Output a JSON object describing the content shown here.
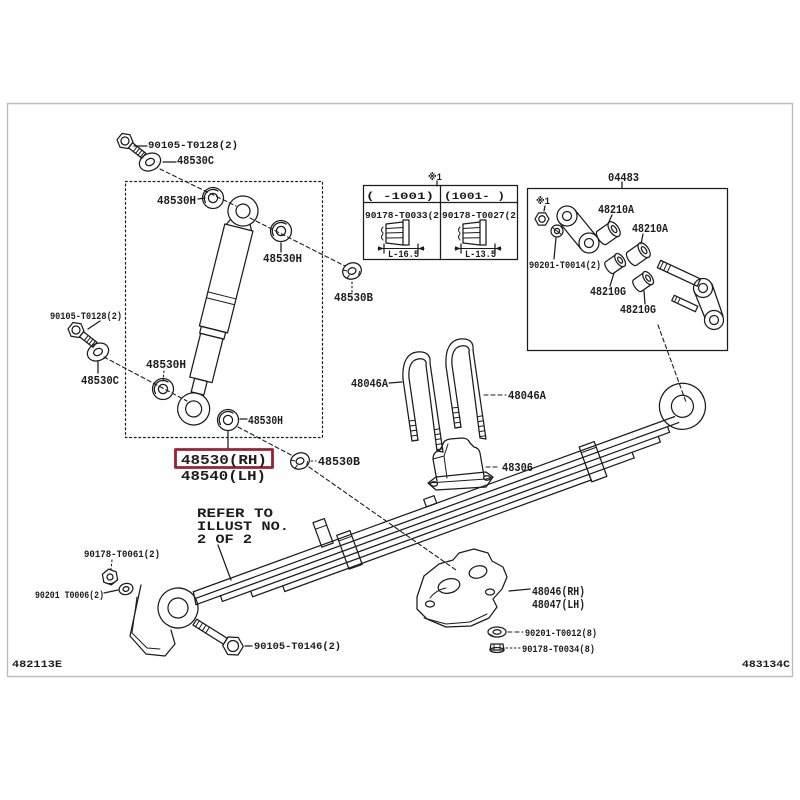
{
  "colors": {
    "line": "#1c1c1c",
    "frame": "#bdbdbd",
    "highlight": "#9e1f33",
    "background": "#ffffff"
  },
  "plate": {
    "code_left": "482113E",
    "code_right": "483134C"
  },
  "highlight": {
    "part_rh": "48530(RH)",
    "part_lh": "48540(LH)"
  },
  "note": {
    "lines": [
      "REFER TO",
      "ILLUST NO.",
      "2 OF 2"
    ]
  },
  "assembly_box": {
    "title": "04483",
    "reference_mark": "※1"
  },
  "table": {
    "reference_mark": "※1",
    "columns": [
      {
        "header": "(    -1001)",
        "part_number": "90178-T0033(2",
        "bolt_length": "L-16.5"
      },
      {
        "header": "(1001-    )",
        "part_number": "90178-T0027(2",
        "bolt_length": "L-13.5"
      }
    ]
  },
  "labels": [
    {
      "id": "label-90105-t0128-top",
      "text": "90105-T0128(2)",
      "x": 148,
      "y": 148,
      "fs": 10.5,
      "w": 90,
      "i": true
    },
    {
      "id": "label-48530c-top",
      "text": "48530C",
      "x": 177,
      "y": 164,
      "fs": 11.5,
      "w": 37,
      "i": true
    },
    {
      "id": "label-48530h-1",
      "text": "48530H",
      "x": 157,
      "y": 204,
      "fs": 11.5,
      "w": 39,
      "i": true
    },
    {
      "id": "label-48530h-2",
      "text": "48530H",
      "x": 263,
      "y": 262,
      "fs": 11.5,
      "w": 39,
      "i": true
    },
    {
      "id": "label-48530b-1",
      "text": "48530B",
      "x": 334,
      "y": 301,
      "fs": 11.5,
      "w": 39,
      "i": true
    },
    {
      "id": "label-90105-t0128-left",
      "text": "90105-T0128(2)",
      "x": 50,
      "y": 319,
      "fs": 10.5,
      "w": 72,
      "i": true
    },
    {
      "id": "label-48530c-left",
      "text": "48530C",
      "x": 81,
      "y": 384,
      "fs": 11.5,
      "w": 38,
      "i": true
    },
    {
      "id": "label-48530h-3",
      "text": "48530H",
      "x": 146,
      "y": 368,
      "fs": 11.5,
      "w": 40,
      "i": true
    },
    {
      "id": "label-48530h-4",
      "text": "48530H",
      "x": 248,
      "y": 424,
      "fs": 11.5,
      "w": 35,
      "i": true
    },
    {
      "id": "label-48530-rh",
      "text": "48530(RH)",
      "x": 181,
      "y": 464,
      "fs": 14,
      "w": 86,
      "i": true
    },
    {
      "id": "label-48540-lh",
      "text": "48540(LH)",
      "x": 181,
      "y": 480,
      "fs": 14,
      "w": 85,
      "i": true
    },
    {
      "id": "label-48530b-2",
      "text": "48530B",
      "x": 318,
      "y": 465,
      "fs": 11.5,
      "w": 42,
      "i": true
    },
    {
      "id": "note-line-1",
      "text": "REFER TO",
      "x": 197,
      "y": 517,
      "fs": 13,
      "w": 76,
      "i": false
    },
    {
      "id": "note-line-2",
      "text": "ILLUST NO.",
      "x": 197,
      "y": 530,
      "fs": 13,
      "w": 92,
      "i": false
    },
    {
      "id": "note-line-3",
      "text": "2 OF 2",
      "x": 197,
      "y": 543,
      "fs": 13,
      "w": 55,
      "i": false
    },
    {
      "id": "label-90178-t0061",
      "text": "90178-T0061(2)",
      "x": 84,
      "y": 557,
      "fs": 10,
      "w": 76,
      "i": true
    },
    {
      "id": "label-90201-t0006",
      "text": "90201 T0006(2)",
      "x": 35,
      "y": 598,
      "fs": 10,
      "w": 69,
      "i": true
    },
    {
      "id": "label-90105-t0146",
      "text": "90105-T0146(2)",
      "x": 254,
      "y": 649,
      "fs": 10.5,
      "w": 87,
      "i": true
    },
    {
      "id": "label-48046a-left",
      "text": "48046A",
      "x": 351,
      "y": 387,
      "fs": 11.5,
      "w": 37,
      "i": true
    },
    {
      "id": "label-48046a-right",
      "text": "48046A",
      "x": 508,
      "y": 399,
      "fs": 11.5,
      "w": 38,
      "i": true
    },
    {
      "id": "label-48306",
      "text": "48306",
      "x": 502,
      "y": 471,
      "fs": 11.5,
      "w": 31,
      "i": true
    },
    {
      "id": "label-48046-rh",
      "text": "48046(RH)",
      "x": 532,
      "y": 595,
      "fs": 12,
      "w": 53,
      "i": true
    },
    {
      "id": "label-48047-lh",
      "text": "48047(LH)",
      "x": 532,
      "y": 608,
      "fs": 12,
      "w": 53,
      "i": true
    },
    {
      "id": "label-90201-t0012",
      "text": "90201-T0012(8)",
      "x": 525,
      "y": 636,
      "fs": 10,
      "w": 72,
      "i": true
    },
    {
      "id": "label-90178-t0034",
      "text": "90178-T0034(8)",
      "x": 522,
      "y": 652,
      "fs": 10,
      "w": 73,
      "i": true
    },
    {
      "id": "label-04483",
      "text": "04483",
      "x": 608,
      "y": 181,
      "fs": 11.5,
      "w": 31,
      "i": true
    },
    {
      "id": "ref-mark-box",
      "text": "※1",
      "x": 536,
      "y": 204,
      "fs": 10,
      "w": 14,
      "i": false
    },
    {
      "id": "label-48210a-1",
      "text": "48210A",
      "x": 598,
      "y": 213,
      "fs": 11.5,
      "w": 36,
      "i": true
    },
    {
      "id": "label-48210a-2",
      "text": "48210A",
      "x": 632,
      "y": 232,
      "fs": 11.5,
      "w": 36,
      "i": true
    },
    {
      "id": "label-90201-t0014",
      "text": "90201-T0014(2)",
      "x": 529,
      "y": 268,
      "fs": 10,
      "w": 72,
      "i": true
    },
    {
      "id": "label-48210g-1",
      "text": "48210G",
      "x": 590,
      "y": 295,
      "fs": 11.5,
      "w": 36,
      "i": true
    },
    {
      "id": "label-48210g-2",
      "text": "48210G",
      "x": 620,
      "y": 313,
      "fs": 11.5,
      "w": 36,
      "i": true
    },
    {
      "id": "ref-mark-table",
      "text": "※1",
      "x": 428,
      "y": 180,
      "fs": 10,
      "w": 14,
      "i": false
    },
    {
      "id": "table-header-left",
      "text": "(    -1001)",
      "x": 366,
      "y": 199,
      "fs": 10,
      "w": 68,
      "i": false
    },
    {
      "id": "table-header-right",
      "text": "(1001-    )",
      "x": 444,
      "y": 199,
      "fs": 10,
      "w": 61,
      "i": false
    },
    {
      "id": "table-part-left",
      "text": "90178-T0033(2",
      "x": 365,
      "y": 218,
      "fs": 9.5,
      "w": 74,
      "i": true
    },
    {
      "id": "table-part-right",
      "text": "90178-T0027(2",
      "x": 442,
      "y": 218,
      "fs": 9.5,
      "w": 74,
      "i": true
    },
    {
      "id": "table-length-left",
      "text": "L-16.5",
      "x": 388,
      "y": 257,
      "fs": 10,
      "w": 31,
      "i": false
    },
    {
      "id": "table-length-right",
      "text": "L-13.5",
      "x": 465,
      "y": 257,
      "fs": 10,
      "w": 31,
      "i": false
    },
    {
      "id": "plate-code-left",
      "text": "482113E",
      "x": 12,
      "y": 667,
      "fs": 10.5,
      "w": 50,
      "i": false
    },
    {
      "id": "plate-code-right",
      "text": "483134C",
      "x": 790,
      "y": 667,
      "fs": 10.5,
      "w": 48,
      "anchor": "end",
      "i": false
    }
  ]
}
